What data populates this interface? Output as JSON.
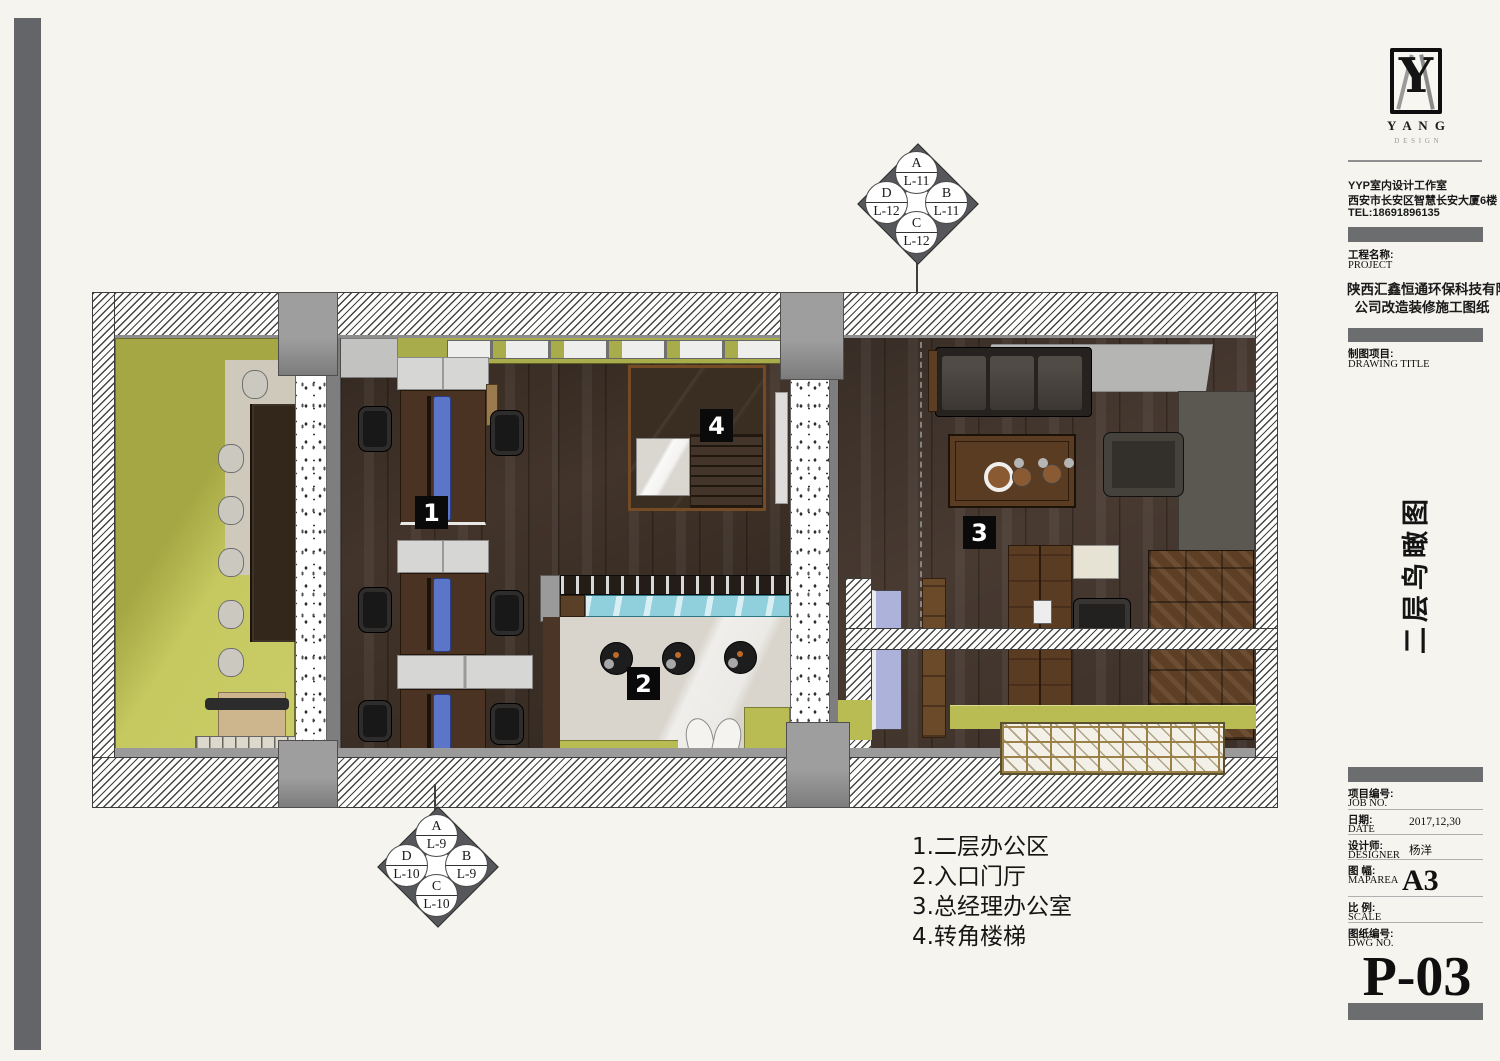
{
  "titleblock": {
    "logo": {
      "monogram": "Y",
      "brand": "Y A N G",
      "brand_sub": "D E S I G N"
    },
    "studio": {
      "line1": "YYP室内设计工作室",
      "line2": "西安市长安区智慧长安大厦6楼",
      "line3": "TEL:18691896135"
    },
    "project": {
      "label_cn": "工程名称:",
      "label_en": "PROJECT",
      "name_line1": "陕西汇鑫恒通环保科技有限",
      "name_line2": "公司改造装修施工图纸"
    },
    "drawing": {
      "label_cn": "制图项目:",
      "label_en": "DRAWING TITLE",
      "title_vertical": "二层鸟瞰图"
    },
    "fields": {
      "job": {
        "cn": "项目编号:",
        "en": "JOB NO."
      },
      "date": {
        "cn": "日期:",
        "en": "DATE",
        "value": "2017,12,30"
      },
      "designer": {
        "cn": "设计师:",
        "en": "DESIGNER",
        "value": "杨洋"
      },
      "maparea": {
        "cn": "图 幅:",
        "en": "MAPAREA",
        "value": "A3"
      },
      "scale": {
        "cn": "比 例:",
        "en": "SCALE"
      },
      "dwgno": {
        "cn": "图纸编号:",
        "en": "DWG NO."
      }
    },
    "sheet_number": "P-03"
  },
  "legend": {
    "items": [
      "1.二层办公区",
      "2.入口门厅",
      "3.总经理办公室",
      "4.转角楼梯"
    ]
  },
  "plan": {
    "labels": {
      "office": "1",
      "hall": "2",
      "manager": "3",
      "stair": "4"
    }
  },
  "markers": {
    "upper": {
      "top_letter": "A",
      "top_level": "L-11",
      "right_letter": "B",
      "right_level": "L-11",
      "bottom_letter": "C",
      "bottom_level": "L-12",
      "left_letter": "D",
      "left_level": "L-12"
    },
    "lower": {
      "top_letter": "A",
      "top_level": "L-9",
      "right_letter": "B",
      "right_level": "L-9",
      "bottom_letter": "C",
      "bottom_level": "L-10",
      "left_letter": "D",
      "left_level": "L-10"
    }
  },
  "colors": {
    "chartreuse": "#b9bc52",
    "wood_floor": "#42342a",
    "glass_blue": "#90d0dd",
    "label_bg": "#0a0a0a",
    "hatch_line": "#3c3c3c"
  }
}
